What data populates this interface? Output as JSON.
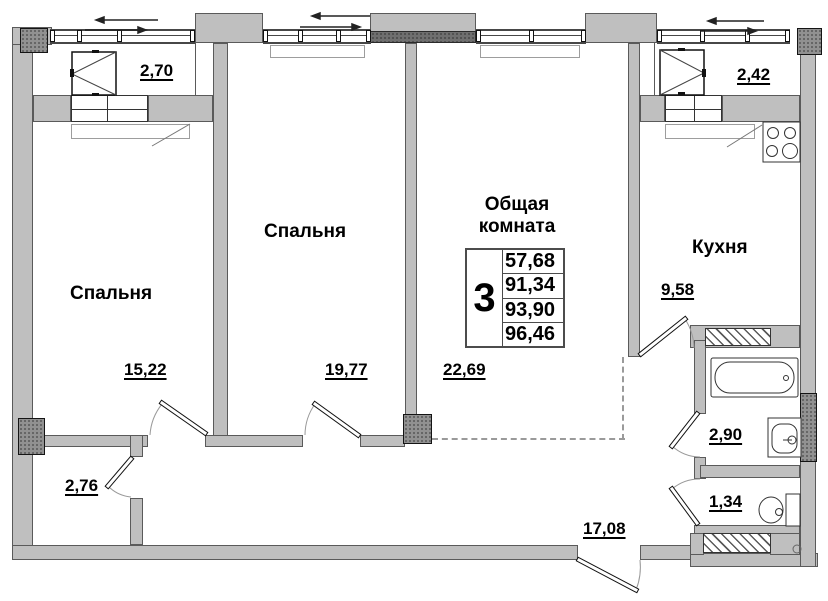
{
  "plan": {
    "colors": {
      "wall_fill": "#bfbfbf",
      "wall_outline": "#5a5a5a",
      "column_fill": "#919191",
      "dashed_line": "#9a9a9a",
      "text": "#000000"
    },
    "rooms": {
      "bedroom_left": {
        "name": "Спальня",
        "area": "15,22"
      },
      "bedroom_middle": {
        "name": "Спальня",
        "area": "19,77"
      },
      "living_room": {
        "name": "Общая комната",
        "area": "22,69"
      },
      "kitchen": {
        "name": "Кухня",
        "area": "9,58"
      },
      "balcony_left": {
        "area": "2,70"
      },
      "balcony_right": {
        "area": "2,42"
      },
      "bathroom": {
        "area": "2,90"
      },
      "toilet": {
        "area": "1,34"
      },
      "closet": {
        "area": "2,76"
      },
      "hallway": {
        "area": "17,08"
      }
    },
    "summary_table": {
      "rooms_count": "3",
      "values": [
        "57,68",
        "91,34",
        "93,90",
        "96,46"
      ]
    }
  }
}
